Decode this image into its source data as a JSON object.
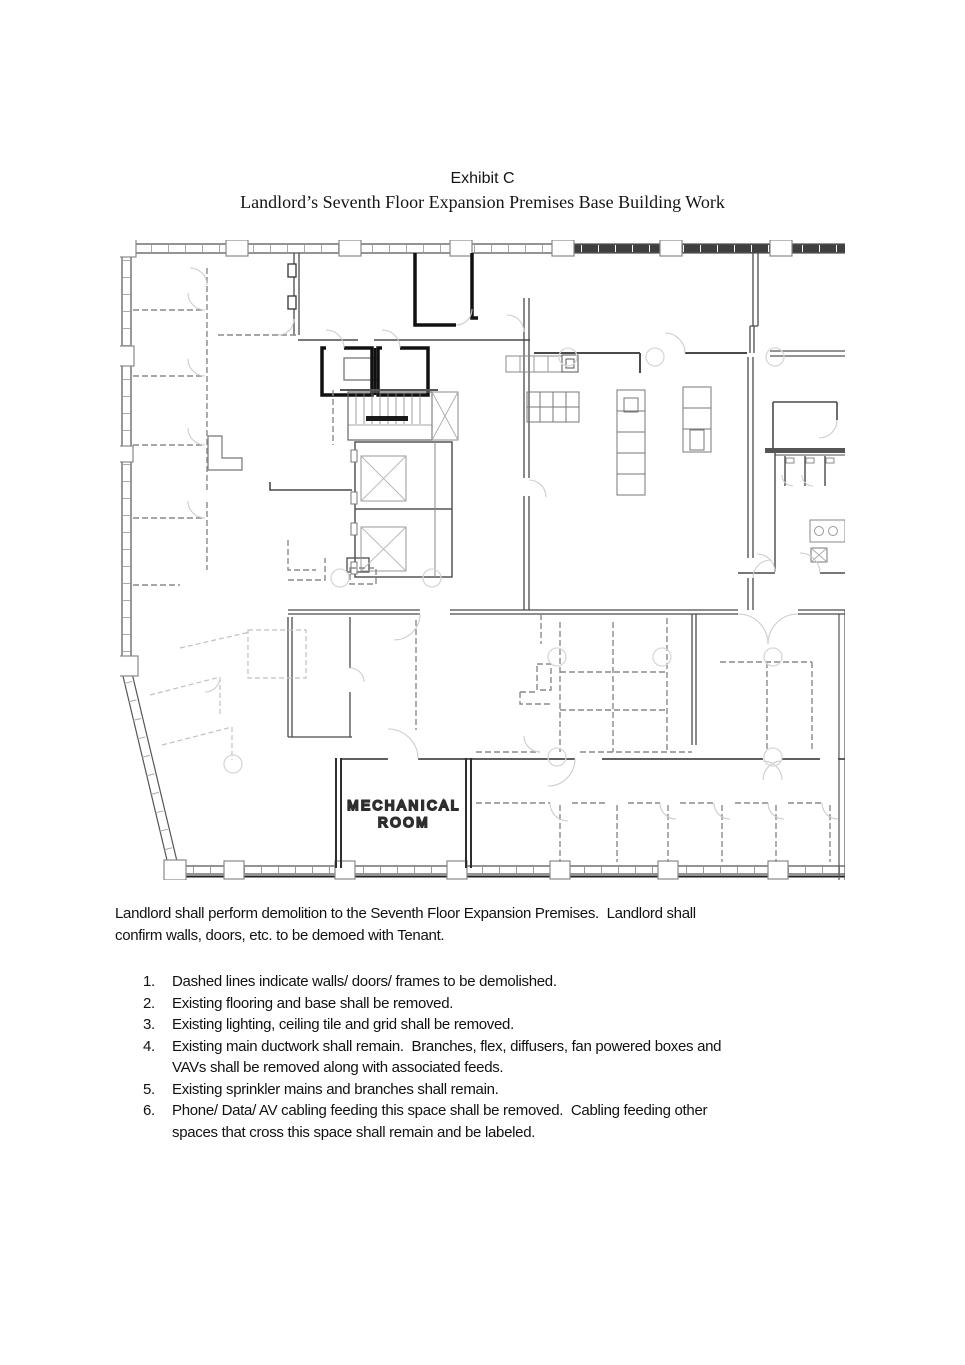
{
  "header": {
    "title": "Exhibit C",
    "subtitle": "Landlord’s Seventh Floor Expansion Premises Base Building Work"
  },
  "floor_plan": {
    "room_label_line1": "MECHANICAL",
    "room_label_line2": "ROOM"
  },
  "intro": {
    "text": "Landlord shall perform demolition to the Seventh Floor Expansion Premises.  Landlord shall\nconfirm walls, doors, etc. to be demoed with Tenant."
  },
  "list": {
    "items": [
      {
        "number": "1.",
        "text": "Dashed lines indicate walls/ doors/ frames to be demolished."
      },
      {
        "number": "2.",
        "text": "Existing flooring and base shall be removed."
      },
      {
        "number": "3.",
        "text": "Existing lighting, ceiling tile and grid shall be removed."
      },
      {
        "number": "4.",
        "text": "Existing main ductwork shall remain.  Branches, flex, diffusers, fan powered boxes and\nVAVs shall be removed along with associated feeds."
      },
      {
        "number": "5.",
        "text": "Existing sprinkler mains and branches shall remain."
      },
      {
        "number": "6.",
        "text": "Phone/ Data/ AV cabling feeding this space shall be removed.  Cabling feeding other\nspaces that cross this space shall remain and be labeled."
      }
    ]
  },
  "colors": {
    "wall_dark": "#3f3f3f",
    "wall": "#555555",
    "demolition_dash": "#8a8a8a",
    "door_swing": "#cccccc",
    "room_label": "#9a9a9a"
  }
}
